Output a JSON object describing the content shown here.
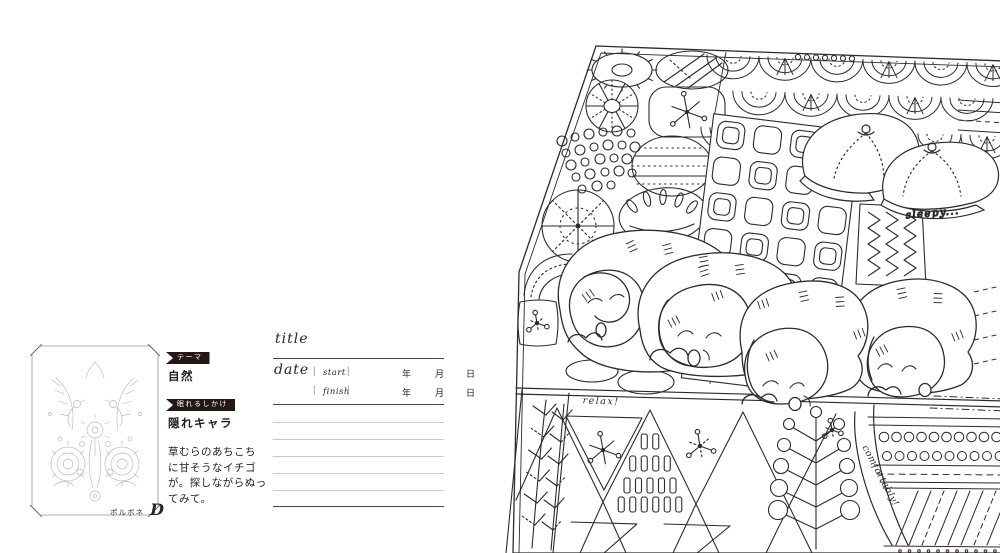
{
  "colors": {
    "ink": "#2e2a28",
    "ribbon_bg": "#231815",
    "rule_dark": "#4a4442",
    "rule_light": "#ccc9c6",
    "thumb_ink": "#b6afab"
  },
  "left_page": {
    "credit": "ポルボネ",
    "monogram": "D",
    "meta": {
      "theme_label": "テーマ",
      "theme_value": "自然",
      "gimmick_label": "眠れるしかけ",
      "gimmick_value": "隠れキャラ",
      "description_lines": [
        "草むらのあちこち",
        "に甘そうなイチゴ",
        "が。探しながらぬっ",
        "てみて。"
      ]
    },
    "form": {
      "title_label": "title",
      "date_label": "date",
      "start_label": "start",
      "finish_label": "finish",
      "year_label": "年",
      "month_label": "月",
      "day_label": "日"
    }
  },
  "illustration": {
    "labels": {
      "sleepy": "sleepy...",
      "relax": "relax!",
      "comfortably": "comfortably!"
    }
  }
}
